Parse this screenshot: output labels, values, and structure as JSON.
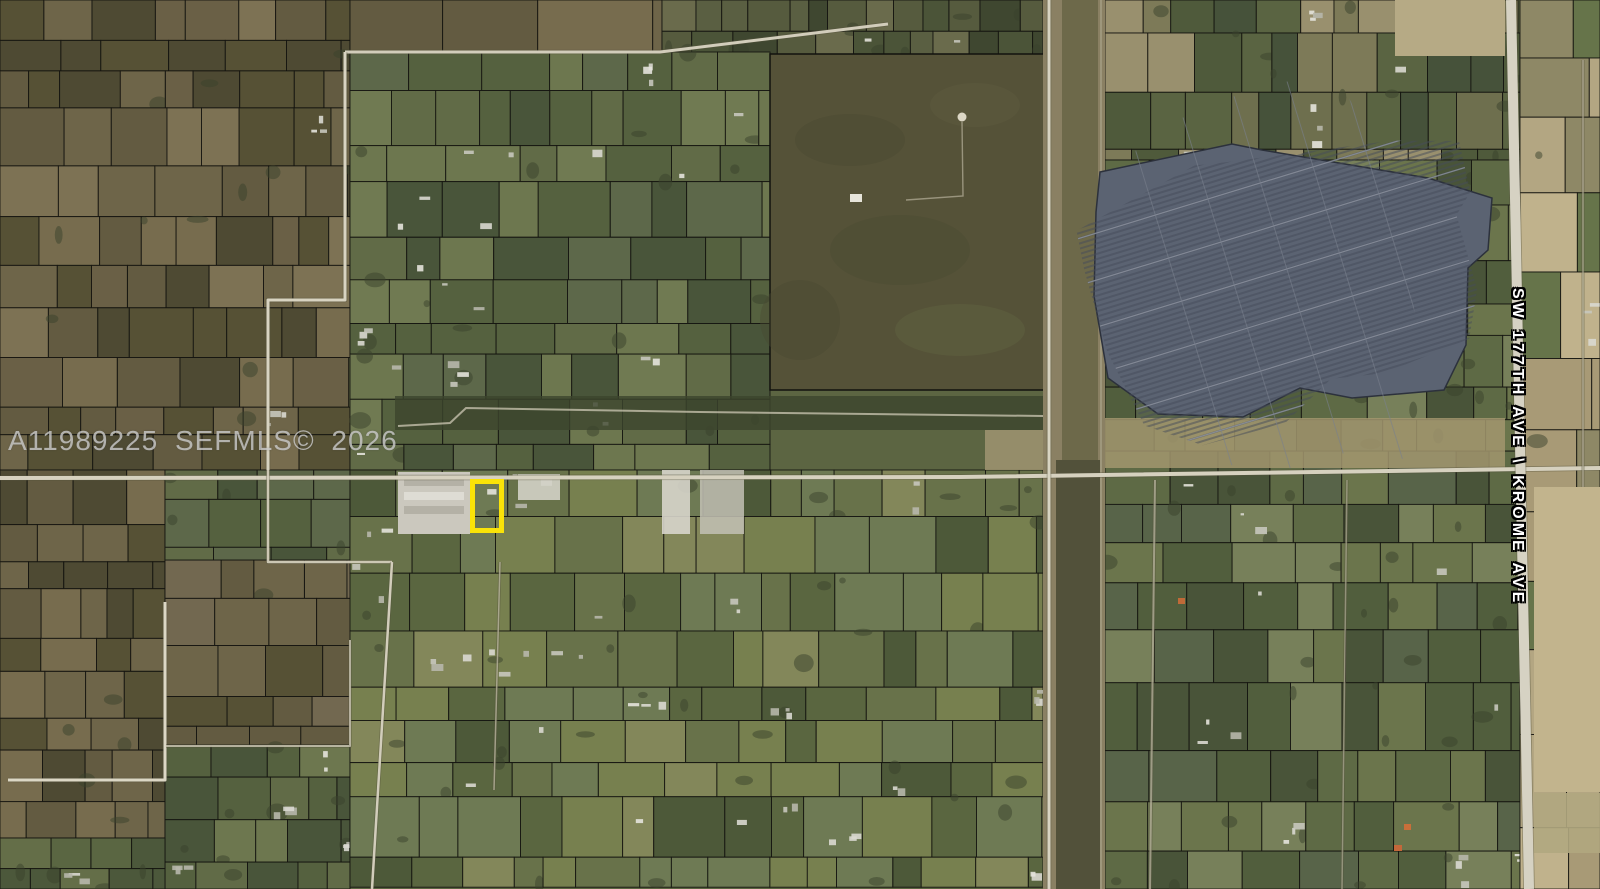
{
  "meta": {
    "type": "satellite-parcel-map-photo",
    "width": 1600,
    "height": 889
  },
  "overlays": {
    "watermark": {
      "text": "A11989225 SEFMLS© 2026",
      "mls_number": "A11989225",
      "attribution": "SEFMLS© 2026",
      "x": 8,
      "y": 425,
      "font_size": 28,
      "color": "#c8c8c8",
      "opacity": 0.82
    },
    "road_label": {
      "text": "SW 177TH AVE \\ KROME AVE",
      "x": 1508,
      "y": 288,
      "font_size": 16,
      "letter_spacing": 4,
      "color": "#ffffff",
      "outline_color": "#000000"
    },
    "highlight": {
      "x": 470,
      "y": 479,
      "width": 34,
      "height": 54,
      "border_color": "#fae308",
      "border_width": 5
    }
  },
  "map": {
    "seed": 20260,
    "base_color": "#5c6542",
    "speck_colors": [
      "#d9d8d0",
      "#c6c6bc",
      "#e4e3db",
      "#b7b7ab"
    ],
    "regions": [
      {
        "name": "scrub-top-left",
        "x": 0,
        "y": 0,
        "w": 350,
        "h": 470,
        "cw": [
          26,
          68
        ],
        "rh": [
          24,
          58
        ],
        "palette": [
          "#6e6549",
          "#776c4e",
          "#635b41",
          "#565135",
          "#7d7254",
          "#4e4a33",
          "#6a6046"
        ],
        "speck": 0.02,
        "tree": 0.1
      },
      {
        "name": "scrub-top-strip",
        "x": 350,
        "y": 0,
        "w": 312,
        "h": 52,
        "cw": [
          60,
          120
        ],
        "rh": [
          48,
          54
        ],
        "palette": [
          "#6e6549",
          "#635b41",
          "#776c4e"
        ],
        "speck": 0,
        "tree": 0.05
      },
      {
        "name": "top-mid-strip",
        "x": 662,
        "y": 0,
        "w": 381,
        "h": 54,
        "cw": [
          18,
          46
        ],
        "rh": [
          24,
          52
        ],
        "palette": [
          "#4b5438",
          "#5a5f42",
          "#6a6b4c",
          "#3f4730",
          "#565b3e"
        ],
        "speck": 0.1,
        "tree": 0.3
      },
      {
        "name": "mid-left-greens",
        "x": 350,
        "y": 52,
        "w": 420,
        "h": 418,
        "cw": [
          30,
          76
        ],
        "rh": [
          28,
          62
        ],
        "palette": [
          "#55613f",
          "#616b47",
          "#6d774f",
          "#49553a",
          "#5d684a",
          "#707a52"
        ],
        "speck": 0.14,
        "tree": 0.3
      },
      {
        "name": "left-scrub-lower",
        "x": 0,
        "y": 470,
        "w": 165,
        "h": 368,
        "cw": [
          26,
          60
        ],
        "rh": [
          26,
          55
        ],
        "palette": [
          "#6e6549",
          "#635b41",
          "#776c4e",
          "#565135",
          "#4e4a33"
        ],
        "speck": 0.03,
        "tree": 0.1
      },
      {
        "name": "left-scrub-lower2",
        "x": 165,
        "y": 560,
        "w": 225,
        "h": 185,
        "cw": [
          30,
          64
        ],
        "rh": [
          28,
          56
        ],
        "palette": [
          "#6e6549",
          "#635b41",
          "#726850",
          "#565135"
        ],
        "speck": 0.03,
        "tree": 0.12
      },
      {
        "name": "left-greens-mid",
        "x": 165,
        "y": 470,
        "w": 185,
        "h": 90,
        "cw": [
          30,
          62
        ],
        "rh": [
          28,
          48
        ],
        "palette": [
          "#55613f",
          "#616b47",
          "#49553a",
          "#5d684a"
        ],
        "speck": 0.1,
        "tree": 0.25
      },
      {
        "name": "left-greens-bottom",
        "x": 165,
        "y": 745,
        "w": 185,
        "h": 144,
        "cw": [
          28,
          60
        ],
        "rh": [
          28,
          52
        ],
        "palette": [
          "#55613f",
          "#616b47",
          "#6d774f",
          "#49553a"
        ],
        "speck": 0.12,
        "tree": 0.3
      },
      {
        "name": "left-greens-corner",
        "x": 0,
        "y": 838,
        "w": 165,
        "h": 51,
        "cw": [
          28,
          60
        ],
        "rh": [
          24,
          50
        ],
        "palette": [
          "#5a6642",
          "#646e48",
          "#4c583b"
        ],
        "speck": 0.08,
        "tree": 0.25
      },
      {
        "name": "bottom-mid-greens",
        "x": 350,
        "y": 470,
        "w": 693,
        "h": 419,
        "cw": [
          28,
          72
        ],
        "rh": [
          30,
          64
        ],
        "palette": [
          "#5a6640",
          "#68724a",
          "#77804f",
          "#4d5939",
          "#83875a",
          "#6e7a54"
        ],
        "speck": 0.15,
        "tree": 0.3
      },
      {
        "name": "right-top",
        "x": 1105,
        "y": 0,
        "w": 415,
        "h": 160,
        "cw": [
          24,
          52
        ],
        "rh": [
          28,
          60
        ],
        "palette": [
          "#5a6442",
          "#6e6f4e",
          "#99906e",
          "#4f5a3b",
          "#7d7a58",
          "#46523a"
        ],
        "speck": 0.12,
        "tree": 0.35
      },
      {
        "name": "right-main",
        "x": 1105,
        "y": 160,
        "w": 415,
        "h": 729,
        "cw": [
          30,
          70
        ],
        "rh": [
          30,
          68
        ],
        "palette": [
          "#515e3d",
          "#5e6a45",
          "#6b754c",
          "#495439",
          "#77805a",
          "#586449"
        ],
        "speck": 0.12,
        "tree": 0.3
      },
      {
        "name": "far-right-strip",
        "x": 1520,
        "y": 0,
        "w": 80,
        "h": 889,
        "cw": [
          40,
          80
        ],
        "rh": [
          45,
          95
        ],
        "palette": [
          "#b3a682",
          "#a89a76",
          "#c0b28c",
          "#66744a",
          "#8e8866"
        ],
        "speck": 0.03,
        "tree": 0.1
      }
    ],
    "features": [
      {
        "t": "rect",
        "x": 770,
        "y": 54,
        "w": 274,
        "h": 336,
        "fill": "#555238",
        "stroke": "#12120e",
        "sw": 1.5
      },
      {
        "t": "ellipse",
        "cx": 850,
        "cy": 140,
        "rx": 55,
        "ry": 26,
        "fill": "#4b4a31",
        "op": 0.5
      },
      {
        "t": "ellipse",
        "cx": 975,
        "cy": 105,
        "rx": 45,
        "ry": 22,
        "fill": "#5e5c40",
        "op": 0.4
      },
      {
        "t": "ellipse",
        "cx": 900,
        "cy": 250,
        "rx": 70,
        "ry": 35,
        "fill": "#4c4b33",
        "op": 0.45
      },
      {
        "t": "ellipse",
        "cx": 960,
        "cy": 330,
        "rx": 65,
        "ry": 26,
        "fill": "#60623f",
        "op": 0.5
      },
      {
        "t": "ellipse",
        "cx": 800,
        "cy": 320,
        "rx": 40,
        "ry": 40,
        "fill": "#494831",
        "op": 0.4
      },
      {
        "t": "rect",
        "x": 395,
        "y": 396,
        "w": 650,
        "h": 34,
        "fill": "#3c452d",
        "op": 0.8
      },
      {
        "t": "path",
        "pts": [
          [
            398,
            426
          ],
          [
            450,
            423
          ],
          [
            466,
            408
          ],
          [
            700,
            412
          ],
          [
            1043,
            416
          ]
        ],
        "c": "#cdc8b4",
        "w": 2,
        "op": 0.75
      },
      {
        "t": "rect",
        "x": 1105,
        "y": 418,
        "w": 400,
        "h": 50,
        "fill": "#a2976f",
        "op": 0.85
      },
      {
        "t": "rect",
        "x": 985,
        "y": 430,
        "w": 58,
        "h": 40,
        "fill": "#9f9471",
        "op": 0.85
      },
      {
        "t": "rect",
        "x": 1043,
        "y": 0,
        "w": 62,
        "h": 889,
        "fill": "#8a8063"
      },
      {
        "t": "rect",
        "x": 1062,
        "y": 0,
        "w": 36,
        "h": 460,
        "fill": "#6b6749",
        "op": 0.95
      },
      {
        "t": "rect",
        "x": 1056,
        "y": 460,
        "w": 44,
        "h": 429,
        "fill": "#52513a"
      },
      {
        "t": "path",
        "pts": [
          [
            1101,
            0
          ],
          [
            1101,
            889
          ]
        ],
        "c": "#b2ad93",
        "w": 1.5,
        "op": 0.7
      },
      {
        "t": "rect",
        "x": 398,
        "y": 472,
        "w": 72,
        "h": 62,
        "fill": "#cbc8be"
      },
      {
        "t": "rect",
        "x": 404,
        "y": 478,
        "w": 60,
        "h": 8,
        "fill": "#b4b1a6"
      },
      {
        "t": "rect",
        "x": 404,
        "y": 492,
        "w": 60,
        "h": 8,
        "fill": "#dedcd4"
      },
      {
        "t": "rect",
        "x": 404,
        "y": 506,
        "w": 60,
        "h": 8,
        "fill": "#b4b1a6"
      },
      {
        "t": "rect",
        "x": 518,
        "y": 474,
        "w": 42,
        "h": 26,
        "fill": "#d3d1c7",
        "op": 0.9
      },
      {
        "t": "rect",
        "x": 662,
        "y": 470,
        "w": 28,
        "h": 64,
        "fill": "#d7d5cb",
        "op": 0.9
      },
      {
        "t": "rect",
        "x": 700,
        "y": 470,
        "w": 44,
        "h": 64,
        "fill": "#c3c1b5",
        "op": 0.85
      },
      {
        "t": "rect",
        "x": 1534,
        "y": 487,
        "w": 66,
        "h": 305,
        "fill": "#c2b48d"
      },
      {
        "t": "rect",
        "x": 1395,
        "y": 0,
        "w": 110,
        "h": 56,
        "fill": "#b6aa85"
      },
      {
        "t": "rect",
        "x": 1534,
        "y": 793,
        "w": 66,
        "h": 60,
        "fill": "#b0a77f",
        "op": 0.9
      },
      {
        "t": "circle",
        "cx": 962,
        "cy": 117,
        "r": 4.5,
        "fill": "#dcd7c5"
      },
      {
        "t": "path",
        "pts": [
          [
            962,
            122
          ],
          [
            963,
            196
          ],
          [
            906,
            200
          ]
        ],
        "c": "#b7b19b",
        "w": 1.4,
        "op": 0.7
      },
      {
        "t": "rect",
        "x": 850,
        "y": 194,
        "w": 12,
        "h": 8,
        "fill": "#e6e4da"
      },
      {
        "t": "rect",
        "x": 1404,
        "y": 824,
        "w": 7,
        "h": 6,
        "fill": "#c96f3a"
      },
      {
        "t": "rect",
        "x": 1394,
        "y": 845,
        "w": 8,
        "h": 6,
        "fill": "#c4683a"
      },
      {
        "t": "rect",
        "x": 1178,
        "y": 598,
        "w": 7,
        "h": 6,
        "fill": "#c06a38"
      }
    ],
    "solar": {
      "points": [
        [
          1100,
          172
        ],
        [
          1232,
          144
        ],
        [
          1262,
          150
        ],
        [
          1428,
          178
        ],
        [
          1492,
          198
        ],
        [
          1488,
          250
        ],
        [
          1468,
          268
        ],
        [
          1466,
          345
        ],
        [
          1444,
          390
        ],
        [
          1352,
          398
        ],
        [
          1300,
          388
        ],
        [
          1243,
          417
        ],
        [
          1158,
          414
        ],
        [
          1108,
          378
        ],
        [
          1094,
          296
        ],
        [
          1096,
          212
        ]
      ],
      "fill": "#5b6372",
      "line": "#454c59",
      "seam": "#8d93a0",
      "cross": "#79808e",
      "angle": -17,
      "cx": 1285,
      "cy": 280
    },
    "roads": [
      {
        "pts": [
          [
            0,
            478
          ],
          [
            960,
            477
          ],
          [
            1600,
            468
          ]
        ],
        "w": 4,
        "c": "#d6d1bf"
      },
      {
        "pts": [
          [
            345,
            52
          ],
          [
            660,
            52
          ],
          [
            888,
            24
          ]
        ],
        "w": 3,
        "c": "#d2cdbb"
      },
      {
        "pts": [
          [
            345,
            52
          ],
          [
            345,
            300
          ],
          [
            268,
            300
          ],
          [
            268,
            470
          ]
        ],
        "w": 3,
        "c": "#d8d3c1"
      },
      {
        "pts": [
          [
            268,
            470
          ],
          [
            268,
            562
          ],
          [
            392,
            562
          ]
        ],
        "w": 2.5,
        "c": "#d8d3c1",
        "op": 0.9
      },
      {
        "pts": [
          [
            165,
            602
          ],
          [
            165,
            780
          ],
          [
            8,
            780
          ]
        ],
        "w": 3,
        "c": "#dcd7c5"
      },
      {
        "pts": [
          [
            350,
            640
          ],
          [
            350,
            746
          ],
          [
            166,
            746
          ]
        ],
        "w": 2,
        "c": "#cfcab8",
        "op": 0.8
      },
      {
        "pts": [
          [
            392,
            562
          ],
          [
            372,
            889
          ]
        ],
        "w": 2.5,
        "c": "#d2cdbb"
      },
      {
        "pts": [
          [
            500,
            562
          ],
          [
            494,
            790
          ]
        ],
        "w": 1.5,
        "c": "#c4bfa9",
        "op": 0.7
      },
      {
        "pts": [
          [
            1155,
            480
          ],
          [
            1150,
            889
          ]
        ],
        "w": 2,
        "c": "#bdb8a2",
        "op": 0.7
      },
      {
        "pts": [
          [
            1347,
            480
          ],
          [
            1342,
            889
          ]
        ],
        "w": 1.5,
        "c": "#bdb8a2",
        "op": 0.6
      },
      {
        "pts": [
          [
            1049,
            0
          ],
          [
            1049,
            889
          ]
        ],
        "w": 3,
        "c": "#d8d4c2"
      },
      {
        "pts": [
          [
            1583,
            60
          ],
          [
            1583,
            487
          ]
        ],
        "w": 1.5,
        "c": "#c8c3ae",
        "op": 0.6
      },
      {
        "pts": [
          [
            1511,
            0
          ],
          [
            1529,
            889
          ]
        ],
        "w": 10,
        "c": "#d6d2c3"
      }
    ]
  }
}
